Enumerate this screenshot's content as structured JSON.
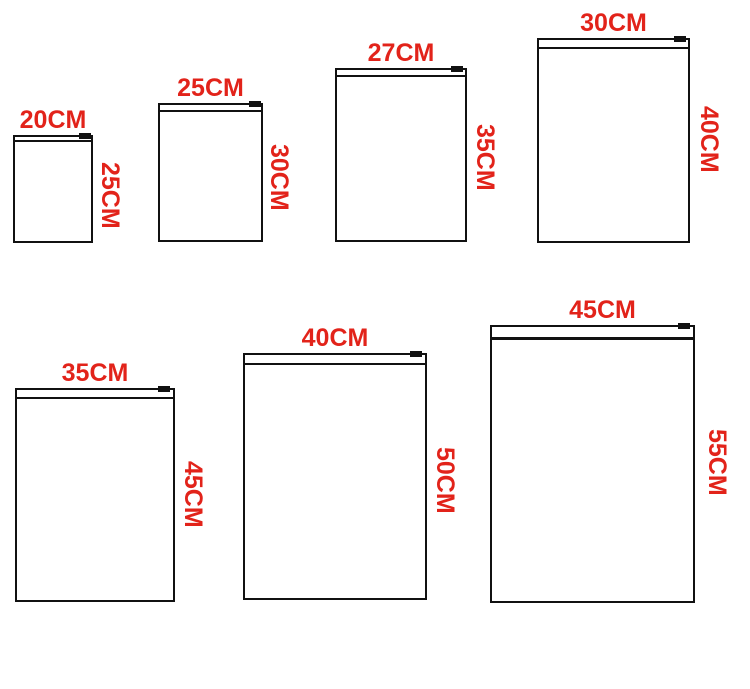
{
  "colors": {
    "label_red": "#e2231a",
    "line_black": "#111111",
    "background": "#ffffff"
  },
  "bags": [
    {
      "width_label": "20CM",
      "height_label": "25CM"
    },
    {
      "width_label": "25CM",
      "height_label": "30CM"
    },
    {
      "width_label": "27CM",
      "height_label": "35CM"
    },
    {
      "width_label": "30CM",
      "height_label": "40CM"
    },
    {
      "width_label": "35CM",
      "height_label": "45CM"
    },
    {
      "width_label": "40CM",
      "height_label": "50CM"
    },
    {
      "width_label": "45CM",
      "height_label": "55CM"
    }
  ]
}
